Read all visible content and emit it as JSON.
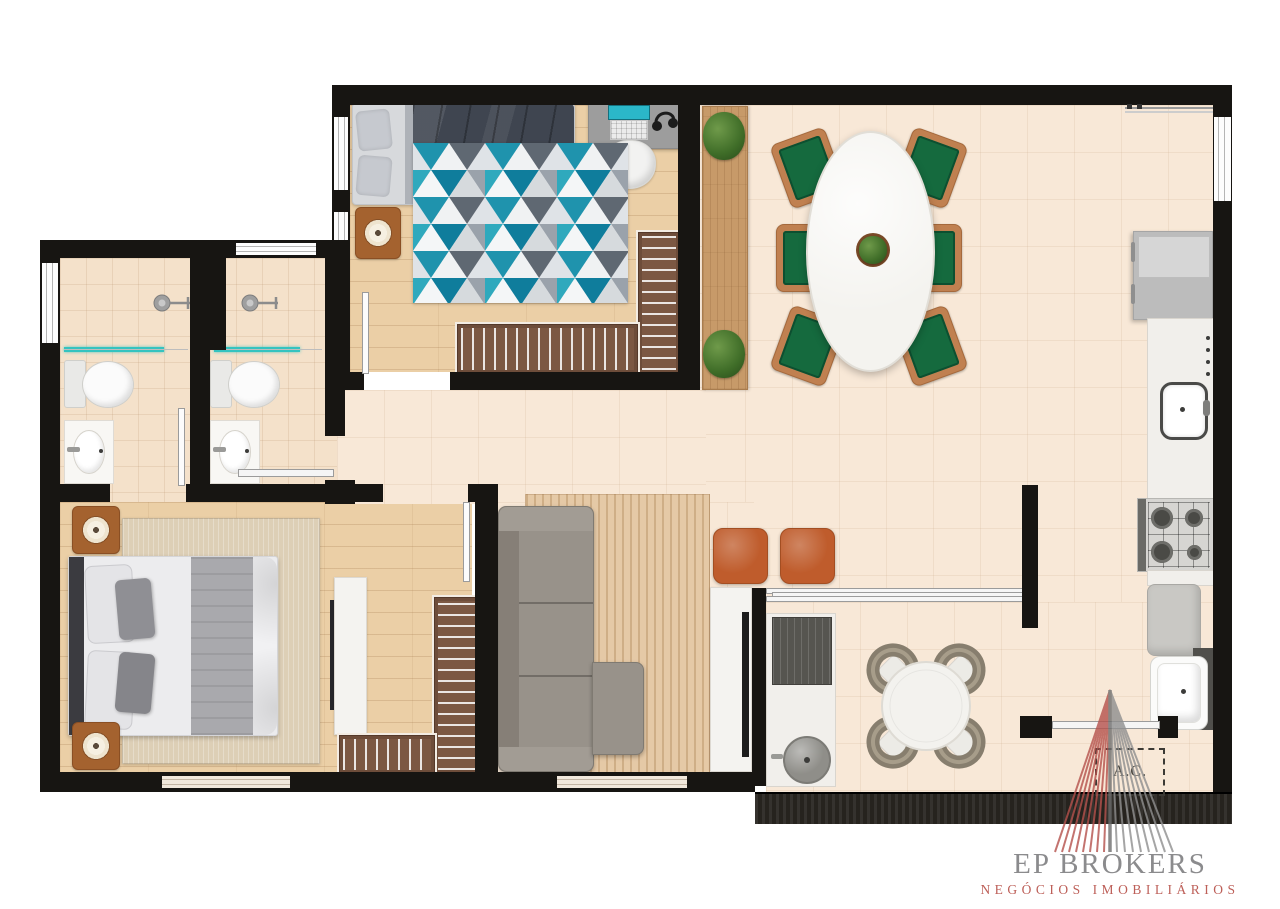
{
  "plan": {
    "ac_label": "A.C."
  },
  "logo": {
    "title": "EP BROKERS",
    "tagline": "NEGÓCIOS IMOBILIÁRIOS"
  },
  "colors": {
    "wall": "#171512",
    "floor_wood": "#ebcfa6",
    "floor_tile": "#f8e8d7",
    "floor_bath": "#f4e1ca",
    "rug_teal": "#1f93ad",
    "rug_slate": "#5f6872",
    "rug_light": "#e6e9ec",
    "chair_green": "#156a3e",
    "chair_wood": "#c08050",
    "ottoman": "#bf5c2c",
    "sofa": "#98928a",
    "wardrobe": "#6e4d3a",
    "sideboard": "#c79a69",
    "plant": "#49752f",
    "screen_teal": "#35c3c0",
    "logo_red": "#b5514c",
    "logo_gray": "#8b8b8d",
    "rail_dark": "#26231e",
    "duvet_dark": "#3f4550"
  }
}
